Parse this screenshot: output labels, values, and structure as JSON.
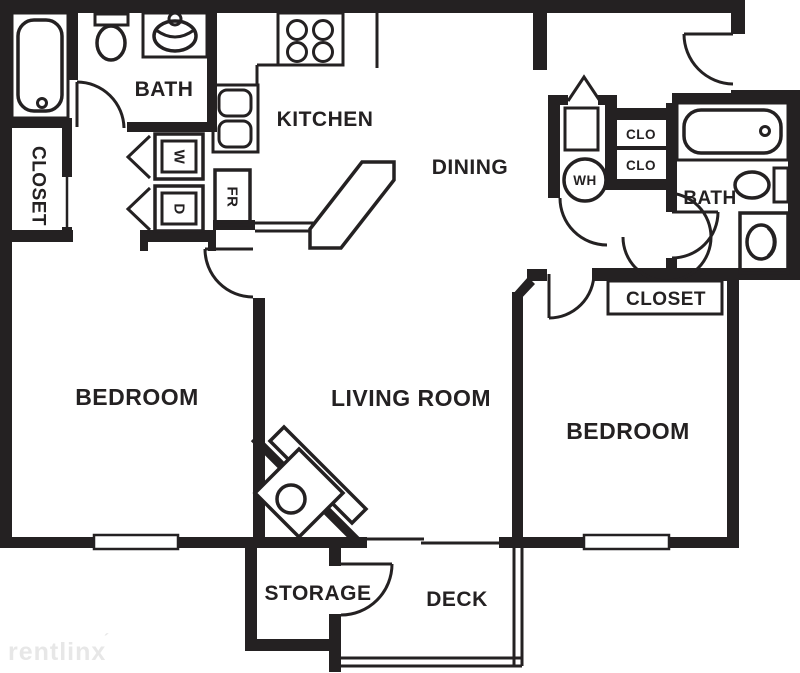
{
  "rooms": {
    "bath_left": "BATH",
    "kitchen": "KITCHEN",
    "dining": "DINING",
    "bath_right": "BATH",
    "bedroom_left": "BEDROOM",
    "living_room": "LIVING ROOM",
    "bedroom_right": "BEDROOM",
    "storage": "STORAGE",
    "deck": "DECK"
  },
  "closets": {
    "left_vertical": "CLOSET",
    "right": "CLOSET",
    "clo_top": "CLO",
    "clo_bottom": "CLO"
  },
  "appliances": {
    "washer": "W",
    "dryer": "D",
    "refrigerator": "FR",
    "water_heater": "WH"
  },
  "watermark": {
    "text": "rentlinx",
    "mark": "´"
  },
  "colors": {
    "line": "#242122",
    "background": "#ffffff",
    "watermark": "#e7e7e7"
  }
}
